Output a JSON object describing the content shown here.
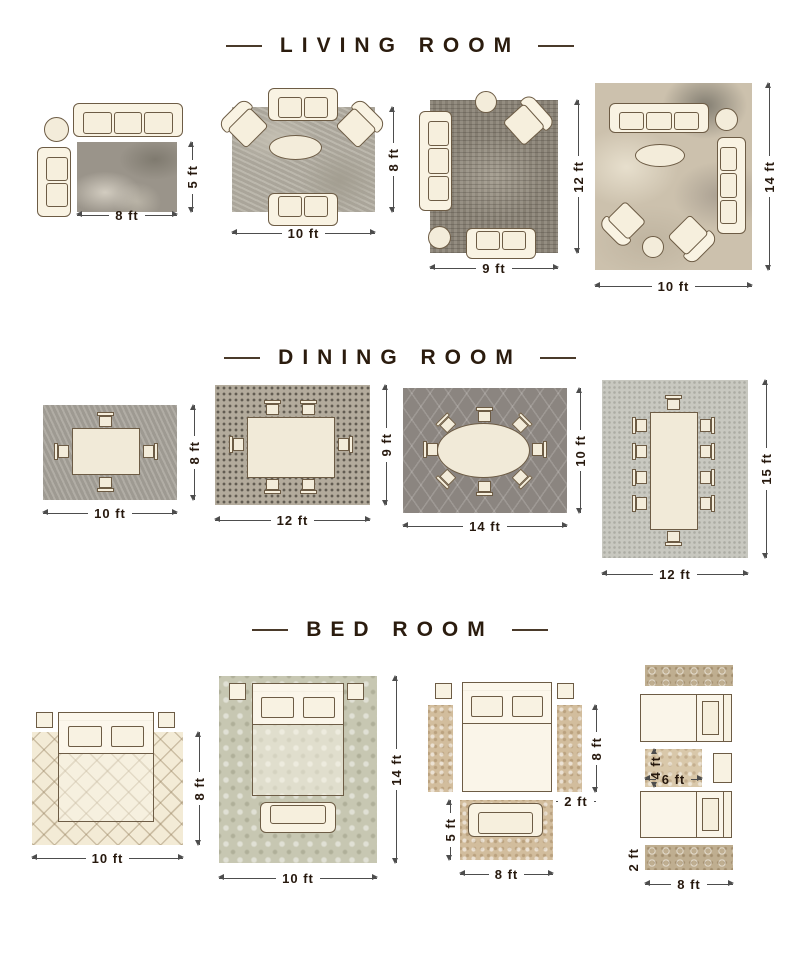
{
  "sections": [
    {
      "title": "LIVING ROOM",
      "layouts": [
        {
          "width_label": "8 ft",
          "height_label": "5 ft"
        },
        {
          "width_label": "10 ft",
          "height_label": "8 ft"
        },
        {
          "width_label": "9 ft",
          "height_label": "12 ft"
        },
        {
          "width_label": "10 ft",
          "height_label": "14 ft"
        }
      ]
    },
    {
      "title": "DINING ROOM",
      "layouts": [
        {
          "width_label": "10 ft",
          "height_label": "8 ft"
        },
        {
          "width_label": "12 ft",
          "height_label": "9 ft"
        },
        {
          "width_label": "14 ft",
          "height_label": "10 ft"
        },
        {
          "width_label": "12 ft",
          "height_label": "15 ft"
        }
      ]
    },
    {
      "title": "BED ROOM",
      "layouts": [
        {
          "width_label": "10 ft",
          "height_label": "8 ft"
        },
        {
          "width_label": "10 ft",
          "height_label": "14 ft"
        },
        {
          "bed_side_label": "8 ft",
          "runner_width_label": "2 ft",
          "foot_rug_height_label": "5 ft",
          "foot_rug_width_label": "8 ft"
        },
        {
          "mid_rug_height_label": "4 ft",
          "mid_rug_width_label": "6 ft",
          "runner_height_label": "2 ft",
          "runner_width_label": "8 ft"
        }
      ]
    }
  ],
  "colors": {
    "title_text": "#2b1c0e",
    "furniture_fill": "#f8f2e2",
    "furniture_outline": "#6d5c45",
    "dimension_line": "#4d4d4d"
  }
}
